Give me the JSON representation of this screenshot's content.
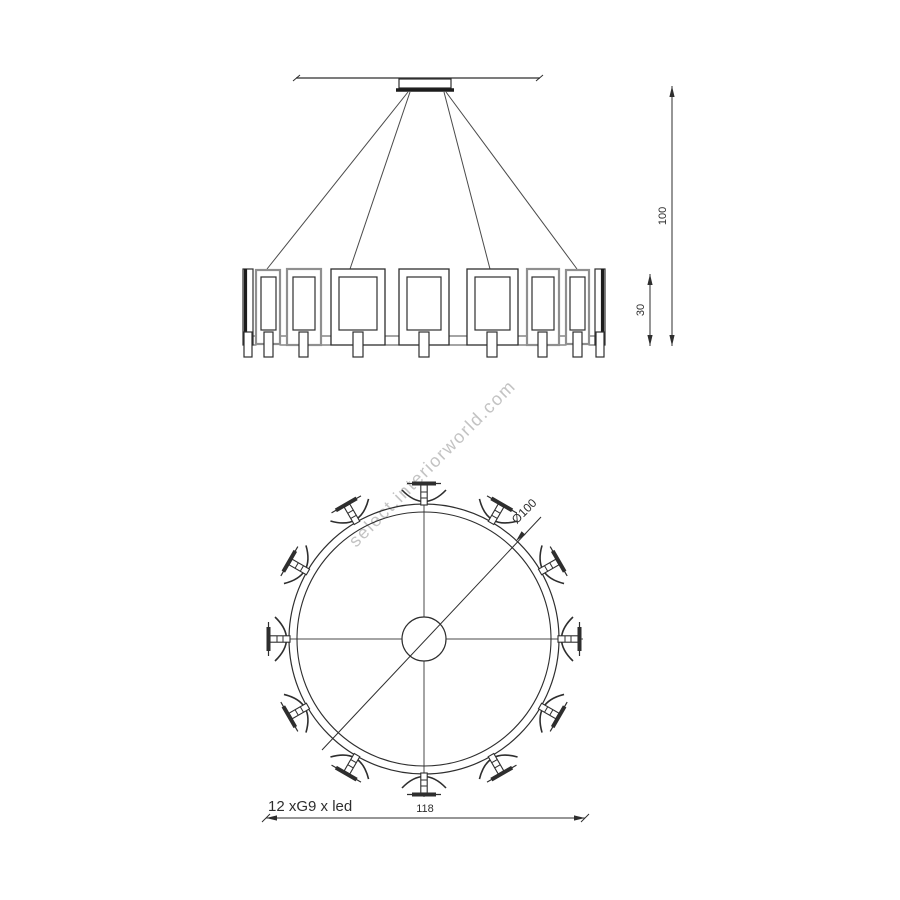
{
  "colors": {
    "line": "#2e2e2e",
    "secondary_line": "#8f8f8f",
    "watermark": "#c3c3c3"
  },
  "watermark": {
    "text": "select.interiorworld.com"
  },
  "elevation_view": {
    "dim_total_height": "100",
    "dim_ring_height": "30"
  },
  "plan_view": {
    "dim_diameter": "Ø100",
    "dim_overall_width": "118",
    "bulb_spec_label": "12 xG9 x led",
    "bulb_count": 12
  }
}
